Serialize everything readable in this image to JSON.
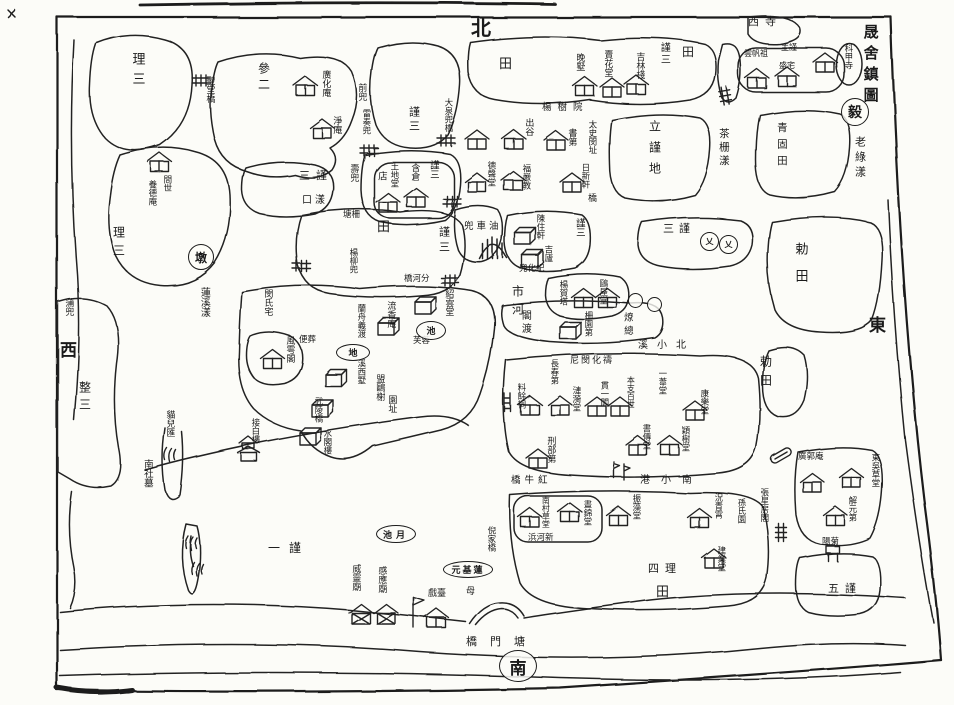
{
  "page": {
    "title": "晟舍鎮圖",
    "ink": "#1c1c1c",
    "paper": "#fcfcf8"
  },
  "map": {
    "labels": [
      {
        "t": "晟舍鎮圖",
        "x": 862,
        "y": 24,
        "s": 15,
        "ls": 6,
        "n": "map-title"
      },
      {
        "t": "老綠漾",
        "x": 854,
        "y": 136,
        "s": 11,
        "ls": 4,
        "n": "water-label"
      },
      {
        "t": "北",
        "x": 471,
        "y": 18,
        "s": 20,
        "o": "h",
        "n": "compass-north"
      },
      {
        "t": "東",
        "x": 869,
        "y": 318,
        "s": 17,
        "o": "h",
        "n": "compass-east"
      },
      {
        "t": "西",
        "x": 60,
        "y": 343,
        "s": 17,
        "o": "h",
        "n": "compass-west"
      },
      {
        "t": "理三",
        "x": 130,
        "y": 52,
        "s": 13,
        "ls": 7
      },
      {
        "t": "參二",
        "x": 257,
        "y": 62,
        "s": 12,
        "ls": 4
      },
      {
        "t": "理三",
        "x": 112,
        "y": 226,
        "s": 12,
        "ls": 6
      },
      {
        "t": "間世",
        "x": 162,
        "y": 175,
        "s": 8.5
      },
      {
        "t": "養德庵",
        "x": 147,
        "y": 180,
        "s": 8.5
      },
      {
        "t": "聖堂橋",
        "x": 204,
        "y": 76,
        "s": 9
      },
      {
        "t": "蒲兜",
        "x": 63,
        "y": 298,
        "s": 9
      },
      {
        "t": "整三",
        "x": 78,
        "y": 381,
        "s": 12,
        "ls": 5
      },
      {
        "t": "蓮溪漾",
        "x": 198,
        "y": 287,
        "s": 10,
        "n": "water-label"
      },
      {
        "t": "廣化庵",
        "x": 320,
        "y": 70,
        "s": 9
      },
      {
        "t": "淨庵",
        "x": 331,
        "y": 116,
        "s": 9
      },
      {
        "t": "前兜",
        "x": 356,
        "y": 83,
        "s": 9
      },
      {
        "t": "雷奏兜",
        "x": 361,
        "y": 109,
        "s": 8.5
      },
      {
        "t": "謹三",
        "x": 408,
        "y": 106,
        "s": 11,
        "ls": 3
      },
      {
        "t": "大泉兜橋",
        "x": 443,
        "y": 98,
        "s": 8.5,
        "n": "bridge-label"
      },
      {
        "t": "田",
        "x": 499,
        "y": 58,
        "s": 13,
        "o": "h",
        "n": "field-label"
      },
      {
        "t": "晚墅",
        "x": 574,
        "y": 53,
        "s": 9
      },
      {
        "t": "賣花堂",
        "x": 602,
        "y": 50,
        "s": 9
      },
      {
        "t": "吉林棧",
        "x": 634,
        "y": 52,
        "s": 9
      },
      {
        "t": "謹三",
        "x": 658,
        "y": 42,
        "s": 10,
        "ls": 2
      },
      {
        "t": "田",
        "x": 682,
        "y": 46,
        "s": 12,
        "o": "h",
        "n": "field-label"
      },
      {
        "t": "西寺",
        "x": 748,
        "y": 16,
        "s": 11,
        "o": "h",
        "ls": 6
      },
      {
        "t": "雲帆祖",
        "x": 744,
        "y": 50,
        "s": 8,
        "o": "h"
      },
      {
        "t": "主謹",
        "x": 781,
        "y": 44,
        "s": 8,
        "o": "h"
      },
      {
        "t": "盛宅",
        "x": 779,
        "y": 62,
        "s": 8,
        "o": "h"
      },
      {
        "t": "科甲寺",
        "x": 843,
        "y": 44,
        "s": 8.5
      },
      {
        "t": "楊樹院",
        "x": 542,
        "y": 103,
        "s": 9.5,
        "o": "h",
        "ls": 6
      },
      {
        "t": "立謹地",
        "x": 648,
        "y": 120,
        "s": 12,
        "ls": 9
      },
      {
        "t": "茶栅漾",
        "x": 718,
        "y": 128,
        "s": 10.5,
        "ls": 3,
        "n": "water-label"
      },
      {
        "t": "青固田",
        "x": 776,
        "y": 122,
        "s": 10.5,
        "ls": 6
      },
      {
        "t": "出谷",
        "x": 523,
        "y": 118,
        "s": 9
      },
      {
        "t": "書第",
        "x": 566,
        "y": 128,
        "s": 9
      },
      {
        "t": "太史閔址",
        "x": 587,
        "y": 120,
        "s": 8.5
      },
      {
        "t": "德聲堂",
        "x": 486,
        "y": 161,
        "s": 8.5
      },
      {
        "t": "福嚴教",
        "x": 521,
        "y": 164,
        "s": 8.5
      },
      {
        "t": "日新軒",
        "x": 580,
        "y": 163,
        "s": 8.5
      },
      {
        "t": "橋",
        "x": 588,
        "y": 195,
        "s": 9,
        "o": "h",
        "n": "bridge-label"
      },
      {
        "t": "壽兜",
        "x": 348,
        "y": 164,
        "s": 9
      },
      {
        "t": "塘柵",
        "x": 343,
        "y": 211,
        "s": 8.5,
        "o": "h"
      },
      {
        "t": "店",
        "x": 376,
        "y": 171,
        "s": 9.5
      },
      {
        "t": "土地堂",
        "x": 389,
        "y": 162,
        "s": 8.5
      },
      {
        "t": "含倉",
        "x": 409,
        "y": 163,
        "s": 9
      },
      {
        "t": "謹三",
        "x": 428,
        "y": 160,
        "s": 9.5
      },
      {
        "t": "三謹",
        "x": 299,
        "y": 170,
        "s": 11,
        "o": "h",
        "ls": 6
      },
      {
        "t": "口漾",
        "x": 302,
        "y": 196,
        "s": 10,
        "o": "h",
        "ls": 3,
        "n": "water-label"
      },
      {
        "t": "田",
        "x": 377,
        "y": 221,
        "s": 13,
        "o": "h",
        "n": "field-label"
      },
      {
        "t": "謹三",
        "x": 438,
        "y": 226,
        "s": 11,
        "ls": 4
      },
      {
        "t": "楊柳兜",
        "x": 348,
        "y": 248,
        "s": 8.5
      },
      {
        "t": "兜車油",
        "x": 464,
        "y": 222,
        "s": 9.5,
        "o": "h",
        "ls": 3
      },
      {
        "t": "陳住軒",
        "x": 535,
        "y": 214,
        "s": 8.5
      },
      {
        "t": "吉廬",
        "x": 543,
        "y": 245,
        "s": 8.5
      },
      {
        "t": "謹三",
        "x": 574,
        "y": 218,
        "s": 9.5
      },
      {
        "t": "兜化紀",
        "x": 519,
        "y": 265,
        "s": 8.5,
        "o": "h"
      },
      {
        "t": "橋河分",
        "x": 404,
        "y": 275,
        "s": 8.5,
        "o": "h",
        "n": "bridge-label"
      },
      {
        "t": "市河",
        "x": 511,
        "y": 285,
        "s": 12,
        "ls": 6,
        "n": "water-label"
      },
      {
        "t": "三謹",
        "x": 663,
        "y": 223,
        "s": 11,
        "o": "h",
        "ls": 5
      },
      {
        "t": "勅田",
        "x": 793,
        "y": 242,
        "s": 13,
        "ls": 14
      },
      {
        "t": "勅田",
        "x": 759,
        "y": 355,
        "s": 12,
        "ls": 7
      },
      {
        "t": "楊賀塔",
        "x": 558,
        "y": 280,
        "s": 8.5
      },
      {
        "t": "鷗屋堂",
        "x": 598,
        "y": 279,
        "s": 8.5
      },
      {
        "t": "閣渡",
        "x": 519,
        "y": 310,
        "s": 10,
        "ls": 3
      },
      {
        "t": "柵園第",
        "x": 583,
        "y": 311,
        "s": 8.5
      },
      {
        "t": "燎總",
        "x": 622,
        "y": 312,
        "s": 9.5,
        "ls": 4
      },
      {
        "t": "溪小北",
        "x": 638,
        "y": 341,
        "s": 10,
        "o": "h",
        "ls": 9,
        "n": "water-label"
      },
      {
        "t": "閔氏宅",
        "x": 262,
        "y": 289,
        "s": 9
      },
      {
        "t": "蘭舟義渡",
        "x": 356,
        "y": 304,
        "s": 8.5
      },
      {
        "t": "流香庵",
        "x": 385,
        "y": 301,
        "s": 9
      },
      {
        "t": "紹雲堂",
        "x": 443,
        "y": 289,
        "s": 9
      },
      {
        "t": "芙蓉",
        "x": 413,
        "y": 337,
        "s": 8.5,
        "o": "h"
      },
      {
        "t": "風雩閣",
        "x": 284,
        "y": 336,
        "s": 9
      },
      {
        "t": "便葬",
        "x": 299,
        "y": 336,
        "s": 8.5,
        "o": "h"
      },
      {
        "t": "溪西墅",
        "x": 356,
        "y": 359,
        "s": 8.5
      },
      {
        "t": "盟鷗榭",
        "x": 374,
        "y": 374,
        "s": 9
      },
      {
        "t": "園址",
        "x": 386,
        "y": 395,
        "s": 9
      },
      {
        "t": "接白樓",
        "x": 250,
        "y": 418,
        "s": 8.5
      },
      {
        "t": "武陵橋",
        "x": 313,
        "y": 397,
        "s": 8.5,
        "n": "bridge-label"
      },
      {
        "t": "水閣樓",
        "x": 322,
        "y": 429,
        "s": 8.5
      },
      {
        "t": "貓兒匯",
        "x": 164,
        "y": 410,
        "s": 9
      },
      {
        "t": "南社墓",
        "x": 142,
        "y": 459,
        "s": 9.5
      },
      {
        "t": "一謹",
        "x": 268,
        "y": 542,
        "s": 12,
        "o": "h",
        "ls": 9
      },
      {
        "t": "尼閔化禱",
        "x": 570,
        "y": 357,
        "s": 9,
        "o": "h",
        "ls": 2
      },
      {
        "t": "長春第",
        "x": 549,
        "y": 359,
        "s": 8.5
      },
      {
        "t": "料餘祠",
        "x": 516,
        "y": 383,
        "s": 8.5
      },
      {
        "t": "漣漪堂",
        "x": 571,
        "y": 386,
        "s": 8.5
      },
      {
        "t": "貫一閣",
        "x": 599,
        "y": 381,
        "s": 8.5
      },
      {
        "t": "本支百世",
        "x": 626,
        "y": 376,
        "s": 8
      },
      {
        "t": "一葦堂",
        "x": 657,
        "y": 369,
        "s": 8.5
      },
      {
        "t": "康樂堂",
        "x": 699,
        "y": 389,
        "s": 8.5
      },
      {
        "t": "書傳堂",
        "x": 641,
        "y": 424,
        "s": 8.5
      },
      {
        "t": "穎樹堂",
        "x": 680,
        "y": 426,
        "s": 8.5
      },
      {
        "t": "刑部第",
        "x": 545,
        "y": 436,
        "s": 9
      },
      {
        "t": "橋牛紅",
        "x": 511,
        "y": 476,
        "s": 9.5,
        "o": "h",
        "ls": 4,
        "n": "bridge-label"
      },
      {
        "t": "港小南",
        "x": 640,
        "y": 476,
        "s": 10,
        "o": "h",
        "ls": 11,
        "n": "water-label"
      },
      {
        "t": "南村草堂",
        "x": 541,
        "y": 496,
        "s": 8
      },
      {
        "t": "晝錦堂",
        "x": 582,
        "y": 500,
        "s": 8.5
      },
      {
        "t": "振藻堂",
        "x": 631,
        "y": 494,
        "s": 8.5
      },
      {
        "t": "況青霄",
        "x": 713,
        "y": 493,
        "s": 8.5
      },
      {
        "t": "孫氏園",
        "x": 736,
        "y": 498,
        "s": 8.5
      },
      {
        "t": "建業堂",
        "x": 716,
        "y": 546,
        "s": 8.5
      },
      {
        "t": "四理",
        "x": 648,
        "y": 563,
        "s": 11,
        "o": "h",
        "ls": 6
      },
      {
        "t": "田",
        "x": 656,
        "y": 586,
        "s": 13,
        "o": "h",
        "n": "field-label"
      },
      {
        "t": "浜河新",
        "x": 528,
        "y": 534,
        "s": 8.5,
        "o": "h"
      },
      {
        "t": "倪家橋",
        "x": 486,
        "y": 526,
        "s": 8.5,
        "n": "bridge-label"
      },
      {
        "t": "威靈廟",
        "x": 350,
        "y": 564,
        "s": 9
      },
      {
        "t": "感應廟",
        "x": 376,
        "y": 566,
        "s": 9
      },
      {
        "t": "戲臺",
        "x": 428,
        "y": 590,
        "s": 9,
        "o": "h"
      },
      {
        "t": "母",
        "x": 466,
        "y": 588,
        "s": 9,
        "o": "h"
      },
      {
        "t": "橋門塘",
        "x": 466,
        "y": 636,
        "s": 11,
        "o": "h",
        "ls": 13,
        "n": "bridge-label"
      },
      {
        "t": "張星房閣",
        "x": 759,
        "y": 488,
        "s": 8.5
      },
      {
        "t": "廣郭庵",
        "x": 798,
        "y": 453,
        "s": 8.5,
        "o": "h"
      },
      {
        "t": "東吳草堂",
        "x": 870,
        "y": 453,
        "s": 8.5
      },
      {
        "t": "解元第",
        "x": 847,
        "y": 496,
        "s": 8.5
      },
      {
        "t": "陽菊",
        "x": 822,
        "y": 538,
        "s": 8.5,
        "o": "h"
      },
      {
        "t": "五謹",
        "x": 828,
        "y": 583,
        "s": 11,
        "o": "h",
        "ls": 6
      }
    ],
    "ovals": [
      {
        "t": "池",
        "x": 416,
        "y": 321,
        "w": 28,
        "h": 17,
        "s": 9
      },
      {
        "t": "地",
        "x": 336,
        "y": 344,
        "w": 32,
        "h": 15,
        "s": 9
      },
      {
        "t": "池月",
        "x": 376,
        "y": 525,
        "w": 38,
        "h": 16,
        "s": 9,
        "ls": 4
      },
      {
        "t": "元基蓮",
        "x": 443,
        "y": 561,
        "w": 48,
        "h": 15,
        "s": 9,
        "ls": 2
      },
      {
        "t": "南",
        "x": 499,
        "y": 650,
        "w": 36,
        "h": 30,
        "s": 17,
        "n": "compass-south"
      }
    ],
    "circles": [
      {
        "t": "墩",
        "x": 188,
        "y": 244,
        "d": 24
      },
      {
        "t": "毅",
        "x": 841,
        "y": 98,
        "d": 26,
        "n": "seal-mark"
      },
      {
        "t": "乂",
        "x": 700,
        "y": 232,
        "d": 17
      },
      {
        "t": "乂",
        "x": 719,
        "y": 235,
        "d": 17
      },
      {
        "t": "",
        "x": 628,
        "y": 293,
        "d": 13
      },
      {
        "t": "",
        "x": 647,
        "y": 297,
        "d": 13
      }
    ],
    "houses": [
      {
        "x": 160,
        "y": 162,
        "t": "h"
      },
      {
        "x": 305,
        "y": 85,
        "t": "h"
      },
      {
        "x": 322,
        "y": 128,
        "t": "h"
      },
      {
        "x": 585,
        "y": 86,
        "t": "h"
      },
      {
        "x": 612,
        "y": 87,
        "t": "h"
      },
      {
        "x": 636,
        "y": 84,
        "t": "h"
      },
      {
        "x": 757,
        "y": 78,
        "t": "h"
      },
      {
        "x": 787,
        "y": 76,
        "t": "h"
      },
      {
        "x": 825,
        "y": 62,
        "t": "h"
      },
      {
        "x": 477,
        "y": 139,
        "t": "h"
      },
      {
        "x": 514,
        "y": 139,
        "t": "h"
      },
      {
        "x": 556,
        "y": 140,
        "t": "h"
      },
      {
        "x": 477,
        "y": 182,
        "t": "h"
      },
      {
        "x": 513,
        "y": 180,
        "t": "h"
      },
      {
        "x": 572,
        "y": 182,
        "t": "h"
      },
      {
        "x": 388,
        "y": 202,
        "t": "h"
      },
      {
        "x": 416,
        "y": 197,
        "t": "h"
      },
      {
        "x": 525,
        "y": 236,
        "t": "b"
      },
      {
        "x": 532,
        "y": 258,
        "t": "b"
      },
      {
        "x": 583,
        "y": 297,
        "t": "h"
      },
      {
        "x": 607,
        "y": 297,
        "t": "h"
      },
      {
        "x": 570,
        "y": 330,
        "t": "b"
      },
      {
        "x": 425,
        "y": 305,
        "t": "b"
      },
      {
        "x": 388,
        "y": 326,
        "t": "b"
      },
      {
        "x": 272,
        "y": 358,
        "t": "h"
      },
      {
        "x": 335,
        "y": 377,
        "t": "b"
      },
      {
        "x": 322,
        "y": 408,
        "t": "b"
      },
      {
        "x": 310,
        "y": 436,
        "t": "b"
      },
      {
        "x": 250,
        "y": 445,
        "t": "p"
      },
      {
        "x": 530,
        "y": 405,
        "t": "h"
      },
      {
        "x": 560,
        "y": 405,
        "t": "h"
      },
      {
        "x": 597,
        "y": 406,
        "t": "h"
      },
      {
        "x": 620,
        "y": 406,
        "t": "h"
      },
      {
        "x": 695,
        "y": 410,
        "t": "h"
      },
      {
        "x": 638,
        "y": 445,
        "t": "h"
      },
      {
        "x": 670,
        "y": 445,
        "t": "h"
      },
      {
        "x": 538,
        "y": 458,
        "t": "h"
      },
      {
        "x": 530,
        "y": 517,
        "t": "h"
      },
      {
        "x": 570,
        "y": 512,
        "t": "h"
      },
      {
        "x": 618,
        "y": 515,
        "t": "h"
      },
      {
        "x": 700,
        "y": 518,
        "t": "h"
      },
      {
        "x": 714,
        "y": 558,
        "t": "h"
      },
      {
        "x": 812,
        "y": 482,
        "t": "h"
      },
      {
        "x": 852,
        "y": 478,
        "t": "h"
      },
      {
        "x": 835,
        "y": 515,
        "t": "h"
      },
      {
        "x": 362,
        "y": 612,
        "t": "t"
      },
      {
        "x": 387,
        "y": 612,
        "t": "t"
      },
      {
        "x": 437,
        "y": 618,
        "t": "h"
      }
    ],
    "bridges": [
      {
        "x": 192,
        "y": 76,
        "r": 0
      },
      {
        "x": 360,
        "y": 146,
        "r": 0
      },
      {
        "x": 437,
        "y": 136,
        "r": 0
      },
      {
        "x": 443,
        "y": 197,
        "r": 0
      },
      {
        "x": 728,
        "y": 86,
        "r": 80
      },
      {
        "x": 293,
        "y": 262,
        "r": 0
      },
      {
        "x": 441,
        "y": 276,
        "r": 0
      },
      {
        "x": 786,
        "y": 524,
        "r": 90
      }
    ],
    "markers": [
      {
        "t": "flag",
        "x": 414,
        "y": 598,
        "r": 0
      },
      {
        "t": "pole",
        "x": 614,
        "y": 462,
        "r": 0
      },
      {
        "t": "pole",
        "x": 624,
        "y": 464,
        "r": 0
      },
      {
        "t": "boat",
        "x": 770,
        "y": 458,
        "r": -30
      },
      {
        "t": "ladder",
        "x": 505,
        "y": 394,
        "r": 0
      },
      {
        "t": "pier",
        "x": 826,
        "y": 546,
        "r": 0
      },
      {
        "t": "marsh",
        "x": 184,
        "y": 536,
        "r": 0
      },
      {
        "t": "marsh",
        "x": 190,
        "y": 562,
        "r": 0
      },
      {
        "t": "marsh",
        "x": 163,
        "y": 448,
        "r": 0
      }
    ]
  }
}
